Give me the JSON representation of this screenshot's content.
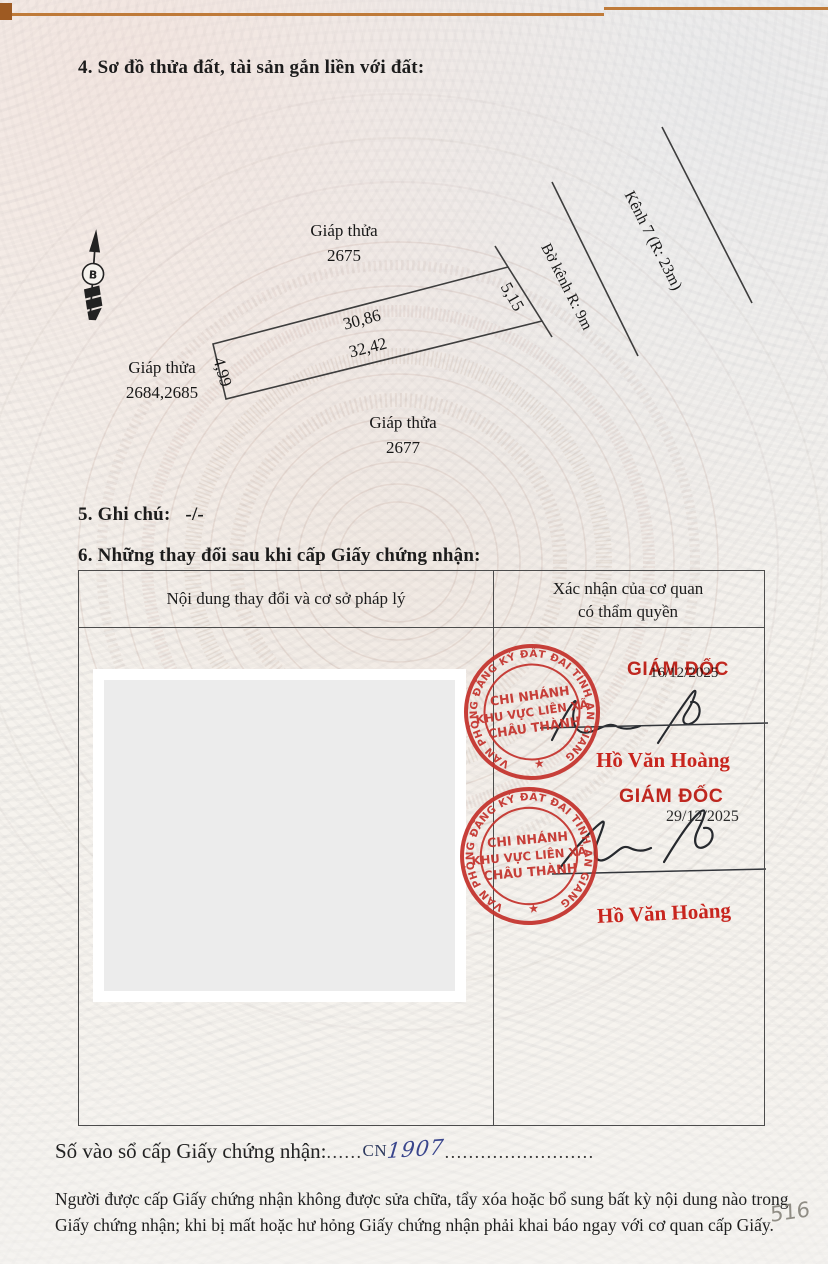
{
  "document": {
    "section4_title": "4. Sơ đồ thửa đất, tài sản gắn liền với đất:",
    "section5_label": "5. Ghi chú:",
    "section5_value": "-/-",
    "section6_title": "6. Những thay đổi sau khi cấp Giấy chứng nhận:"
  },
  "diagram": {
    "north_arrow_label": "B",
    "adjacent_top_line1": "Giáp thửa",
    "adjacent_top_line2": "2675",
    "adjacent_left_line1": "Giáp thửa",
    "adjacent_left_line2": "2684,2685",
    "adjacent_bottom_line1": "Giáp thửa",
    "adjacent_bottom_line2": "2677",
    "edge_top": "30,86",
    "edge_bottom": "32,42",
    "edge_left": "4,99",
    "edge_right": "5,15",
    "canal_bank_label": "Bờ kênh R: 9m",
    "canal_label": "Kênh 7 (R: 23m)"
  },
  "table": {
    "col1_header": "Nội dung thay đổi và cơ sở pháp lý",
    "col2_header_line1": "Xác nhận của cơ quan",
    "col2_header_line2": "có thẩm quyền"
  },
  "stamp": {
    "ring_text": "VĂN PHÒNG ĐĂNG KÝ ĐẤT ĐAI TỈNH AN GIANG",
    "star": "★",
    "center_line1": "CHI NHÁNH",
    "center_line2": "KHU VỰC LIÊN XÃ",
    "center_line3": "CHÂU THÀNH"
  },
  "approvals": [
    {
      "title": "GIÁM ĐỐC",
      "date": "16/12/2025",
      "name": "Hồ Văn Hoàng"
    },
    {
      "title": "GIÁM ĐỐC",
      "date": "29/12/2025",
      "name": "Hồ Văn Hoàng"
    }
  ],
  "registry": {
    "label": "Số vào sổ cấp Giấy chứng nhận:",
    "dots_before": "......",
    "prefix": "CN",
    "number": "1907",
    "dots_after": "........................."
  },
  "footer": {
    "line1": "Người được cấp Giấy chứng nhận không được sửa chữa, tẩy xóa hoặc bổ sung bất kỳ nội dung nào trong",
    "line2": "Giấy chứng nhận; khi bị mất hoặc hư hỏng Giấy chứng nhận phải khai báo ngay với cơ quan cấp Giấy."
  },
  "page_number": "516",
  "colors": {
    "stamp_red": "#c4322c",
    "name_red": "#c8251e",
    "ink_black": "#26292e",
    "ink_blue": "#39458c",
    "pencil_gray": "#908d85"
  }
}
